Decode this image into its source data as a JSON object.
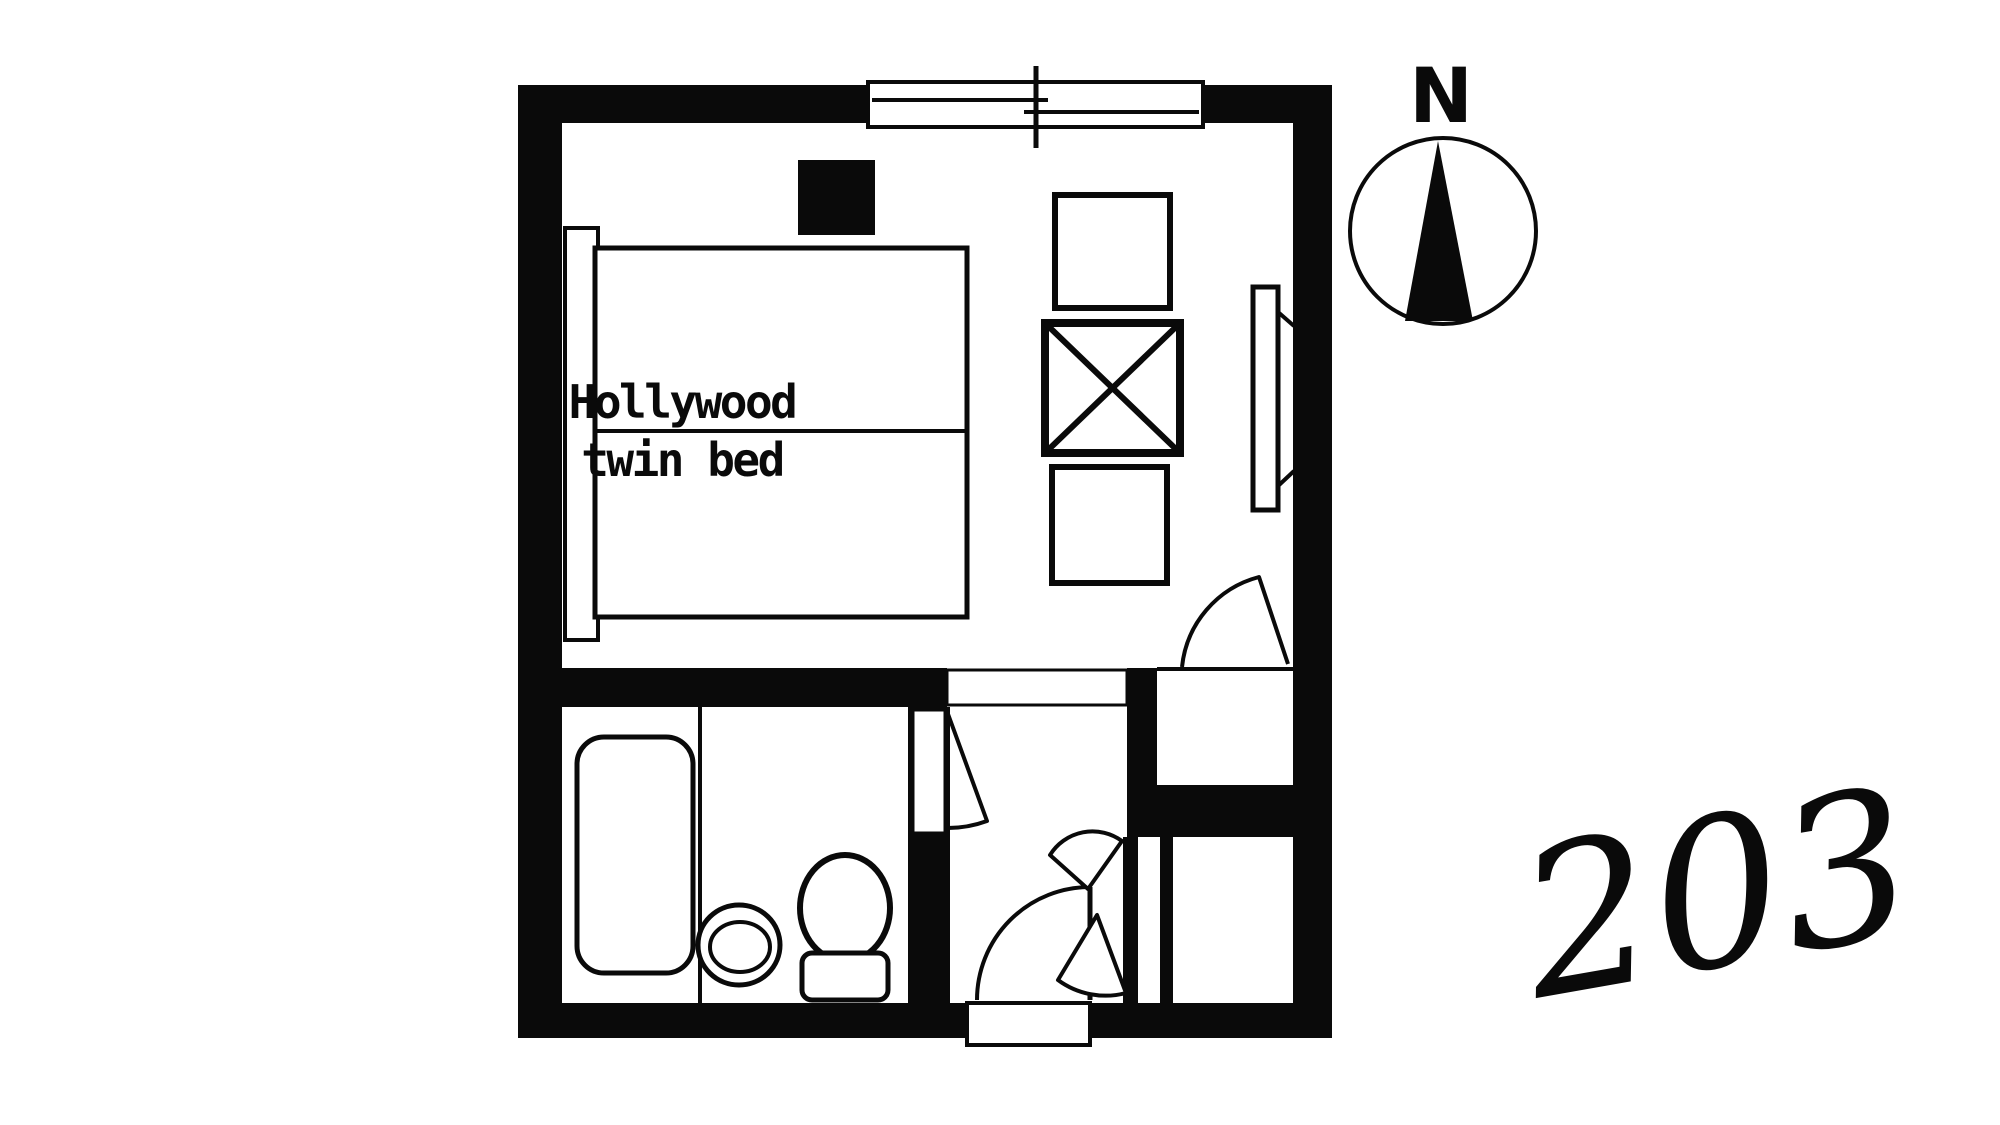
{
  "canvas": {
    "paper_color": "#ffffff",
    "ink_color": "#0a0a0a"
  },
  "floor_plan": {
    "room_number": "203",
    "compass_north_label": "N",
    "bed_label_line1": "Hollywood",
    "bed_label_line2": "twin bed",
    "fixture_icons": [
      "window-icon",
      "bed-icon",
      "headboard-icon",
      "tv-unit-icon",
      "chair-icon",
      "x-table-icon",
      "chair-icon",
      "wall-mirror-icon",
      "compass-icon",
      "bathtub-icon",
      "wash-basin-icon",
      "toilet-icon",
      "bathroom-door-icon",
      "entry-door-icon",
      "closet-double-doors-icon",
      "closet-icon",
      "alcove-door-icon",
      "entry-threshold-icon"
    ]
  }
}
